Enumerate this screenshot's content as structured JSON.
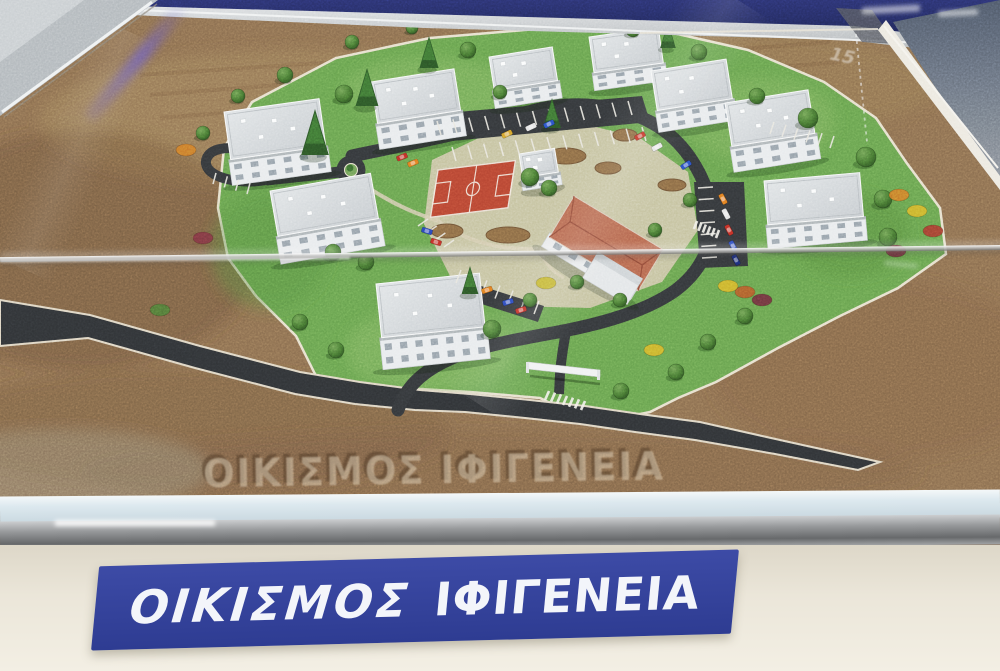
{
  "photo": {
    "subject": "Architectural scale model of a housing settlement displayed in a glass case",
    "plaque": {
      "word_italic": "ΟΙΚΙΣΜΟΣ",
      "word_bold": "ΙΦΙΓΕΝΕΙΑ",
      "bg_color": "#36449d",
      "text_color": "#f3f5fa"
    },
    "base_engraving": {
      "text": "ΟΙΚΙΣΜΟΣ ΙΦΙΓΕΝΕΙΑ"
    },
    "reflections": {
      "soil_mark": "15"
    },
    "palette": {
      "backdrop_navy": "#272f6d",
      "soil_brown": "#8a6d4f",
      "grass_green": "#67a14e",
      "park_beige": "#cfc5a8",
      "loop_road": "#34373a",
      "access_road": "#303336",
      "court_red": "#b64532",
      "roof_gray": "#d3d7da",
      "building_wall": "#e8ebed",
      "hip_roof_terracotta": "#b5674f",
      "case_frame": "#b2b8bc",
      "glass_ledge": "#dde9ef",
      "metal_rail": "#97999b",
      "wall_cream": "#ebe6d9"
    },
    "model": {
      "buildings": [
        [
          224,
          112,
          96,
          48,
          26,
          -8
        ],
        [
          371,
          82,
          84,
          42,
          26,
          -9
        ],
        [
          489,
          57,
          64,
          34,
          18,
          -9
        ],
        [
          589,
          37,
          70,
          36,
          18,
          -8
        ],
        [
          651,
          71,
          76,
          40,
          22,
          -9
        ],
        [
          725,
          103,
          84,
          44,
          26,
          -9
        ],
        [
          764,
          181,
          96,
          44,
          24,
          -5
        ],
        [
          270,
          191,
          102,
          46,
          28,
          -10
        ],
        [
          376,
          284,
          104,
          54,
          32,
          -6
        ],
        [
          519,
          154,
          36,
          24,
          13,
          -9
        ]
      ],
      "trees": [
        [
          344,
          94,
          9
        ],
        [
          468,
          50,
          8
        ],
        [
          500,
          92,
          7
        ],
        [
          530,
          177,
          9
        ],
        [
          549,
          188,
          8
        ],
        [
          808,
          118,
          10
        ],
        [
          866,
          157,
          10
        ],
        [
          883,
          199,
          9
        ],
        [
          888,
          237,
          9
        ],
        [
          757,
          96,
          8
        ],
        [
          699,
          52,
          8
        ],
        [
          633,
          30,
          7
        ],
        [
          285,
          75,
          8
        ],
        [
          238,
          96,
          7
        ],
        [
          203,
          133,
          7
        ],
        [
          333,
          252,
          8
        ],
        [
          300,
          322,
          8
        ],
        [
          336,
          350,
          8
        ],
        [
          621,
          391,
          8
        ],
        [
          676,
          372,
          8
        ],
        [
          708,
          342,
          8
        ],
        [
          745,
          316,
          8
        ],
        [
          620,
          300,
          7
        ],
        [
          577,
          282,
          7
        ],
        [
          492,
          329,
          9
        ],
        [
          530,
          300,
          7
        ],
        [
          366,
          262,
          8
        ],
        [
          412,
          28,
          6
        ],
        [
          352,
          42,
          7
        ],
        [
          655,
          230,
          7
        ],
        [
          690,
          200,
          7
        ]
      ],
      "conifers": [
        [
          315,
          155,
          46
        ],
        [
          367,
          106,
          38
        ],
        [
          429,
          68,
          32
        ],
        [
          552,
          128,
          30
        ],
        [
          470,
          294,
          28
        ],
        [
          668,
          48,
          26
        ]
      ],
      "bushes": [
        [
          186,
          150,
          "#cf7b2a"
        ],
        [
          203,
          238,
          "#7d3642"
        ],
        [
          899,
          195,
          "#cf7b2a"
        ],
        [
          917,
          211,
          "#d3b32c"
        ],
        [
          933,
          231,
          "#a63a30"
        ],
        [
          896,
          251,
          "#6f2e3d"
        ],
        [
          546,
          283,
          "#c2b42e"
        ],
        [
          654,
          350,
          "#d3b32c"
        ],
        [
          745,
          292,
          "#b4592b"
        ],
        [
          762,
          300,
          "#6f2e3d"
        ],
        [
          728,
          286,
          "#d3b32c"
        ],
        [
          160,
          310,
          "#4e7a38"
        ]
      ],
      "beds": [
        [
          447,
          231,
          16,
          7
        ],
        [
          508,
          235,
          22,
          8
        ],
        [
          566,
          156,
          20,
          8
        ],
        [
          608,
          168,
          13,
          6
        ],
        [
          625,
          135,
          12,
          6
        ],
        [
          672,
          185,
          14,
          6
        ]
      ],
      "cars": [
        [
          640,
          136,
          -28,
          "#c23327"
        ],
        [
          657,
          147,
          -28,
          "#e8e8e8"
        ],
        [
          686,
          165,
          -32,
          "#2b50c4"
        ],
        [
          531,
          127,
          -25,
          "#e3e3e3"
        ],
        [
          549,
          124,
          -25,
          "#2b50c4"
        ],
        [
          507,
          134,
          -25,
          "#d3a02c"
        ],
        [
          723,
          199,
          62,
          "#e07a20"
        ],
        [
          726,
          214,
          62,
          "#e3e3e3"
        ],
        [
          729,
          230,
          62,
          "#bf2f26"
        ],
        [
          733,
          246,
          62,
          "#2845b8"
        ],
        [
          736,
          260,
          62,
          "#1d2d77"
        ],
        [
          402,
          157,
          -22,
          "#bf2f26"
        ],
        [
          413,
          163,
          -22,
          "#e07a20"
        ],
        [
          487,
          290,
          -18,
          "#e07a20"
        ],
        [
          508,
          302,
          -18,
          "#2845b8"
        ],
        [
          521,
          310,
          -18,
          "#bf2f26"
        ],
        [
          427,
          231,
          18,
          "#2845b8"
        ],
        [
          436,
          242,
          18,
          "#bf2f26"
        ]
      ],
      "parking_ticks": [
        [
          437,
          121,
          628,
          101,
          12,
          4,
          14
        ],
        [
          452,
          147,
          642,
          127,
          12,
          4,
          14
        ],
        [
          698,
          188,
          702,
          258,
          6,
          15,
          -1
        ],
        [
          456,
          283,
          534,
          314,
          6,
          5,
          -13
        ],
        [
          418,
          226,
          444,
          247,
          3,
          10,
          -7
        ],
        [
          213,
          184,
          247,
          194,
          3,
          3,
          -11
        ],
        [
          770,
          134,
          830,
          148,
          5,
          4,
          -12
        ]
      ],
      "crosswalks": [
        [
          549,
          391,
          585,
          401,
          6,
          -4,
          9
        ],
        [
          697,
          221,
          719,
          230,
          5,
          -3,
          8
        ]
      ]
    }
  }
}
